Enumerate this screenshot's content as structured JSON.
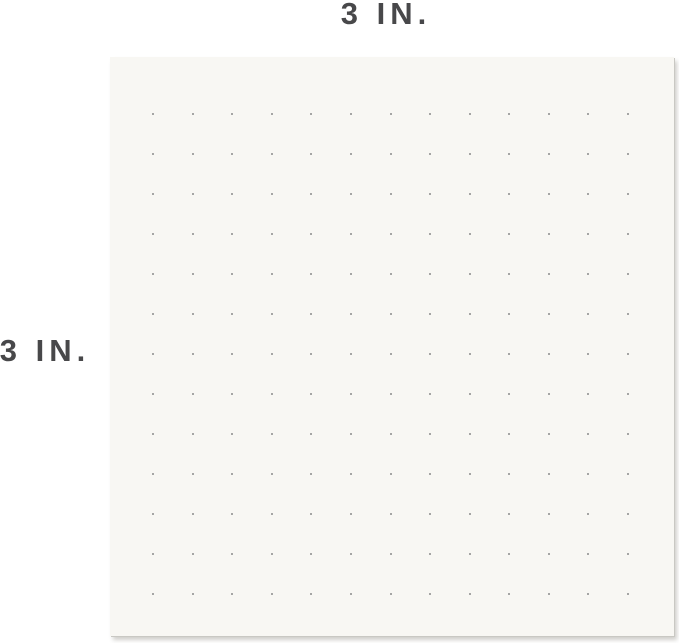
{
  "annotations": {
    "top": {
      "label": "3 IN."
    },
    "left": {
      "label": "3 IN."
    }
  },
  "paper": {
    "dot_grid": {
      "rows": 13,
      "cols": 13
    }
  },
  "colors": {
    "background": "#ffffff",
    "paper": "#f8f7f3",
    "paper_shadow": "#c9c8c3",
    "dot": "#8b8b8b",
    "top_line": "#ababab",
    "top_tick": "#8a8a8a",
    "left_line": "#7e7e7e",
    "left_tick": "#7e7e7e",
    "label_text": "#48484a"
  }
}
